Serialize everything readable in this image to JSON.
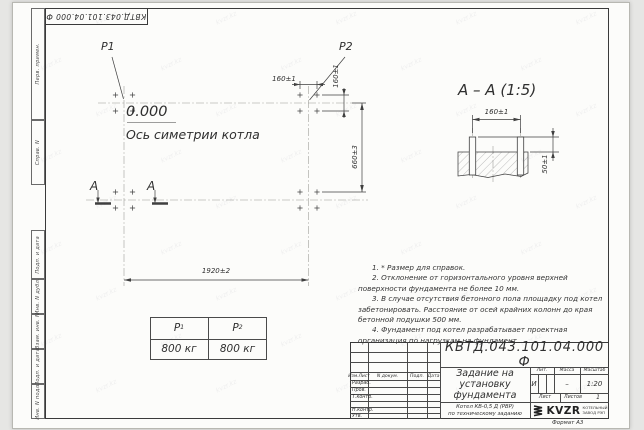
{
  "watermark": "kvzr.kz",
  "top_stamp": "КВТД.043.101.04.000 Ф",
  "margin_labels": [
    "Перв. примен.",
    "Справ. N",
    "Подп. и дата",
    "Инв. N дубл.",
    "Взам. инв. N",
    "Подп. и дата",
    "Инв. N подл."
  ],
  "plan": {
    "p1": "P1",
    "p2": "P2",
    "level": "0.000",
    "axis_label": "Ось симетрии котла",
    "section_letter": "А",
    "dim_160_top": "160±1",
    "dim_160_side": "160±1",
    "dim_660": "660±3",
    "dim_1920": "1920±2"
  },
  "section_view": {
    "title": "А – А (1:5)",
    "dim_width": "160±1",
    "dim_height": "50±1"
  },
  "load_table": {
    "col1": {
      "symbol": "P",
      "sub": "1",
      "value": "800 кг"
    },
    "col2": {
      "symbol": "P",
      "sub": "2",
      "value": "800 кг"
    }
  },
  "notes": [
    "1. * Размер для справок.",
    "2. Отклонение от горизонтального уровня верхней поверхности фундамента не более 10 мм.",
    "3. В случае отсутствия бетонного пола площадку под котел забетонировать. Расстояние от осей крайних колонн до края бетонной подушки 500 мм.",
    "4. Фундамент под котел разрабатывает проектная организация по нагрузкам на фундамент."
  ],
  "title_block": {
    "designation": "КВТД.043.101.04.000 Ф",
    "doc_name": "Задание на установку фундамента",
    "product_line1": "Котел КВ-0,5 Д (РВР)",
    "product_line2": "по техническому заданию",
    "header_izm": "Изм.Лист",
    "header_doc": "N докум.",
    "header_sign": "Подп.",
    "header_date": "Дата",
    "row_razrab": "Разраб.",
    "row_prov": "Пров.",
    "row_tkontr": "Т.контр.",
    "row_nkontr": "Н.контр.",
    "row_utv": "Утв.",
    "lit_label": "Лит.",
    "mass_label": "Масса",
    "scale_label": "Масштаб",
    "lit_value": "И",
    "mass_value": "–",
    "scale_value": "1:20",
    "sheet_label": "Лист",
    "sheets_label": "Листов",
    "sheets_value": "1",
    "logo_text": "KVZR",
    "company_line1": "КОТЕЛЬНЫЙ",
    "company_line2": "ЗАВОД РЭП",
    "format": "Формат А3"
  }
}
